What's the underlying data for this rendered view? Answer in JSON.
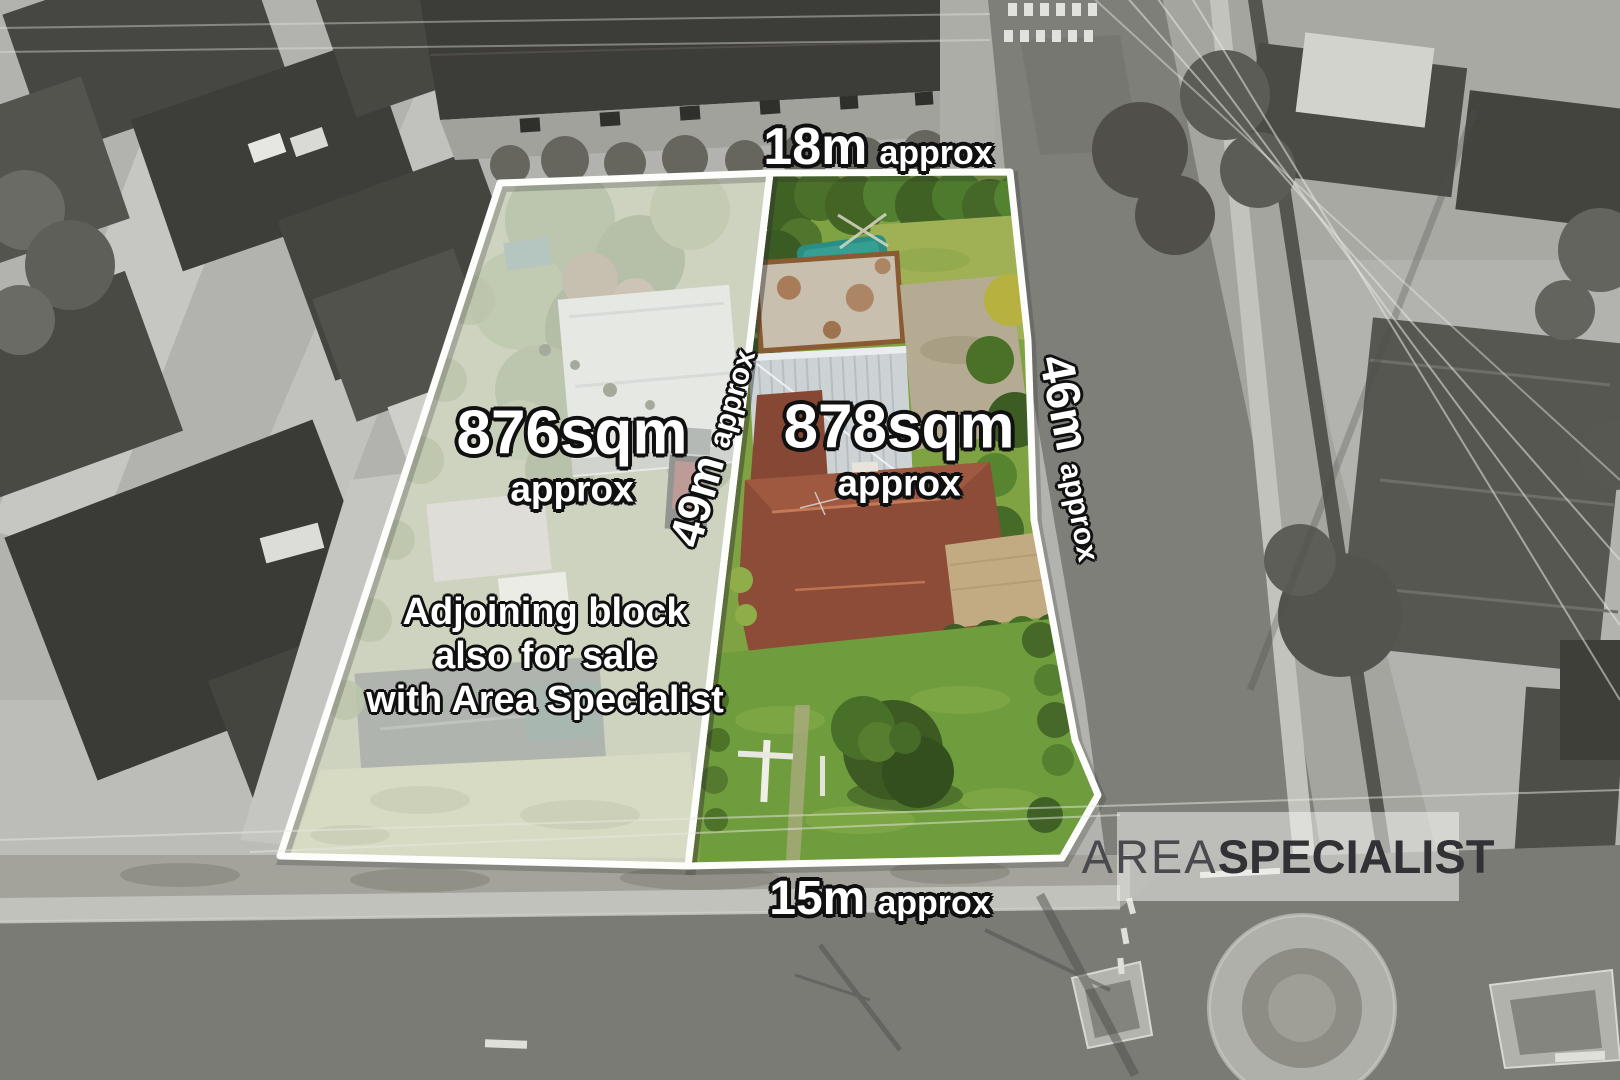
{
  "annotations": {
    "top": {
      "value": "18m",
      "suffix": "approx"
    },
    "right": {
      "value": "46m",
      "suffix": "approx"
    },
    "inner": {
      "value": "49m",
      "suffix": "approx"
    },
    "bottom": {
      "value": "15m",
      "suffix": "approx"
    },
    "lot_left": {
      "area": "876sqm",
      "suffix": "approx"
    },
    "lot_right": {
      "area": "878sqm",
      "suffix": "approx"
    },
    "note_lines": [
      "Adjoining block",
      "also for sale",
      "with Area Specialist"
    ]
  },
  "branding": {
    "light": "AREA",
    "bold": "SPECIALIST"
  },
  "colors": {
    "lot_border": "#ffffff",
    "label_text": "#ffffff",
    "label_outline": "#101010",
    "logo_area": "#4a4a4e",
    "logo_specialist": "#323236",
    "pool": "#2b8e84",
    "main_roof": "#8d4c37",
    "lawn": "#7fa243",
    "metal_roof": "#cdd2d5"
  }
}
